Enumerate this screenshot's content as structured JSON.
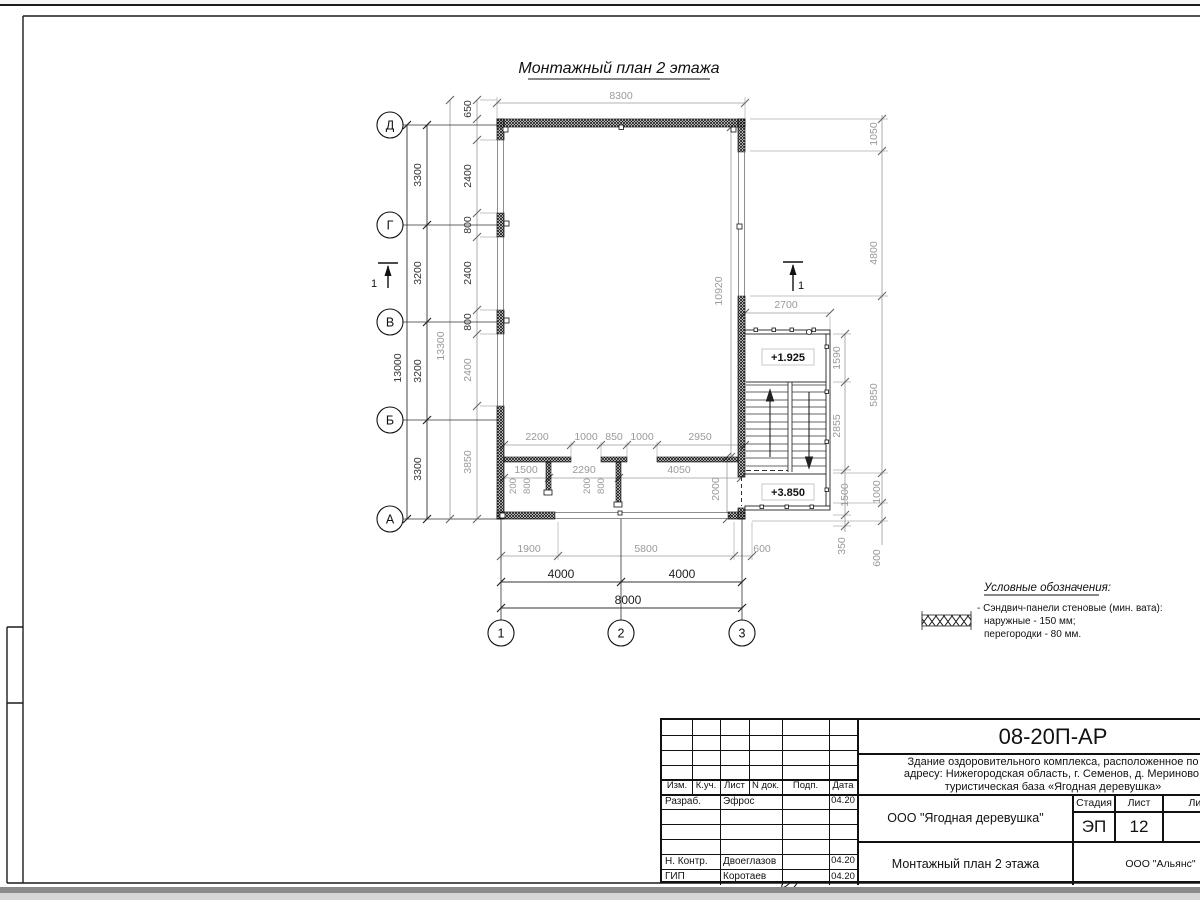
{
  "page": {
    "title": "Монтажный план 2 этажа"
  },
  "axes": {
    "left": [
      "Д",
      "Г",
      "В",
      "Б",
      "А"
    ],
    "bottom": [
      "1",
      "2",
      "3"
    ]
  },
  "section_label": "1",
  "dims": {
    "top_width": "8300",
    "left_axis": [
      "3300",
      "3200",
      "3200",
      "3300"
    ],
    "left_axis_total": "13000",
    "left_panels": [
      "650",
      "2400",
      "800",
      "2400",
      "800",
      "2400",
      "3850"
    ],
    "left_panels_total": "13300",
    "right_inner": [
      "1590",
      "2855",
      "1500",
      "350"
    ],
    "right_outer": [
      "1050",
      "4800",
      "5850",
      "1000",
      "600"
    ],
    "stair_width": "2700",
    "interior_row1": [
      "2200",
      "1000",
      "850",
      "1000",
      "2950"
    ],
    "interior_row2": [
      "1500",
      "2290",
      "4050"
    ],
    "interior_small": [
      "200",
      "800",
      "200",
      "800"
    ],
    "interior_height": "10920",
    "interior_right": "2000",
    "bottom_row1": [
      "1900",
      "5800",
      "600"
    ],
    "bottom_row2": [
      "4000",
      "4000"
    ],
    "bottom_total": "8000"
  },
  "elevations": {
    "upper": "+1.925",
    "lower": "+3.850"
  },
  "legend": {
    "title": "Условные обозначения:",
    "item_line1": "- Сэндвич-панели стеновые (мин. вата):",
    "item_line2": "наружные - 150 мм;",
    "item_line3": "перегородки - 80 мм."
  },
  "title_block": {
    "doc_number": "08-20П-АР",
    "project_line1": "Здание оздоровительного комплекса, расположенное по",
    "project_line2": "адресу: Нижегородская область, г. Семенов, д. Мериново,",
    "project_line3": "туристическая база «Ягодная деревушка»",
    "client": "ООО \"Ягодная деревушка\"",
    "sheet_title": "Монтажный план 2 этажа",
    "contractor": "ООО \"Альянс\"",
    "stage_label": "Стадия",
    "stage_value": "ЭП",
    "sheet_label": "Лист",
    "sheet_value": "12",
    "sheets_label": "Листов",
    "headers": [
      "Изм.",
      "К.уч.",
      "Лист",
      "N док.",
      "Подп.",
      "Дата"
    ],
    "rows": [
      {
        "role": "Разраб.",
        "name": "Эфрос",
        "date": "04.20"
      },
      {
        "role": "Н. Контр.",
        "name": "Двоеглазов",
        "date": "04.20"
      },
      {
        "role": "ГИП",
        "name": "Коротаев",
        "date": "04.20"
      }
    ]
  }
}
